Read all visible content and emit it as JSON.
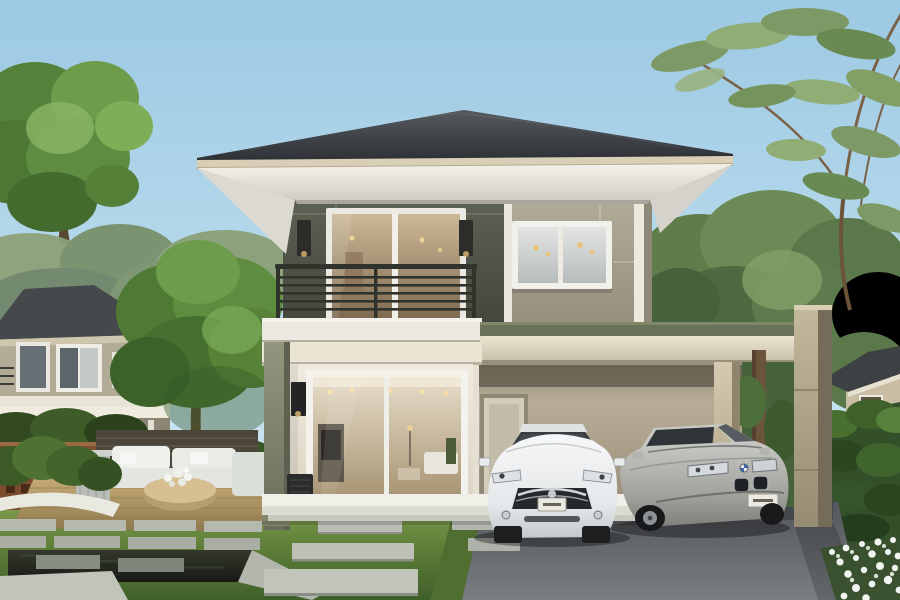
{
  "meta": {
    "description": "3D architectural rendering of a modern two-storey house with hip roof, balcony, large glass windows, attached carport with a white sedan and a silver sedan, front lawn with concrete pavers, reflecting pool with stepping stones, wooden deck with white outdoor lounge furniture, surrounding trees, hedges and neighbouring houses",
    "width_px": 900,
    "height_px": 600
  },
  "scene": {
    "sky": {
      "top_color": "#9fcbe4",
      "horizon_color": "#d9edf6"
    },
    "main_house": {
      "storeys": 2,
      "roof": {
        "type": "hip",
        "color": "#3c4044",
        "fascia_color": "#d8cfb6",
        "soffit_color": "#ece9e1"
      },
      "upper_wall_colors": {
        "balcony_section": "#4f5347",
        "window_section": "#a7a08e"
      },
      "lower_wall_color": "#e9e4d7",
      "trim_color": "#efeee6",
      "balcony": {
        "railing_color": "#30322c",
        "doors": "white-framed sliding glass",
        "wall_sconces": 2
      },
      "upper_right_window": "white-framed double pane, warm pendant lights inside",
      "living_room_window": "full-height glass wall, warm lit interior with ceiling spots, cabinet and sofa",
      "carport": {
        "roof_edge_color": "#6a7159",
        "beam_color": "#e7dfca",
        "pillar_color": "#b0a68a",
        "rear_door": "light grey single door"
      }
    },
    "vehicles": [
      {
        "label": "white sedan, front view, chrome grille, licence plate",
        "body_color": "#eff1f2"
      },
      {
        "label": "silver sedan, three-quarter front view, twin kidney grille, roundel badge, licence plate",
        "body_color": "#a2a39f"
      }
    ],
    "landscape": {
      "lawn_color": "#5d7e39",
      "driveway_color": "#63666b",
      "paver_color": "#b9bdb4",
      "pool": {
        "water_color": "#22251e",
        "stone_rim_color": "#c0c4bb",
        "stepping_stones": true
      },
      "deck": {
        "wood_color": "#b59c6a",
        "furniture": "white L-shaped lounge sofa with round rattan ottoman and white flowers"
      },
      "screen_walls": {
        "brown_breeze_block": "#7c4c2f",
        "dark_slat_fence": "#4c463a"
      },
      "hedge_color": "#33502a",
      "flower_bed": "white ground-cover flowers, bottom right",
      "tree_colors": [
        "#5e8c3c",
        "#79a855",
        "#6c8a55",
        "#82a066"
      ]
    },
    "neighbour_houses": [
      {
        "position": "left background",
        "wall_color": "#b2ab96",
        "roof_color": "#45494c"
      },
      {
        "position": "right background",
        "wall_color": "#c9bda4",
        "roof_color": "#3d4144"
      }
    ]
  }
}
